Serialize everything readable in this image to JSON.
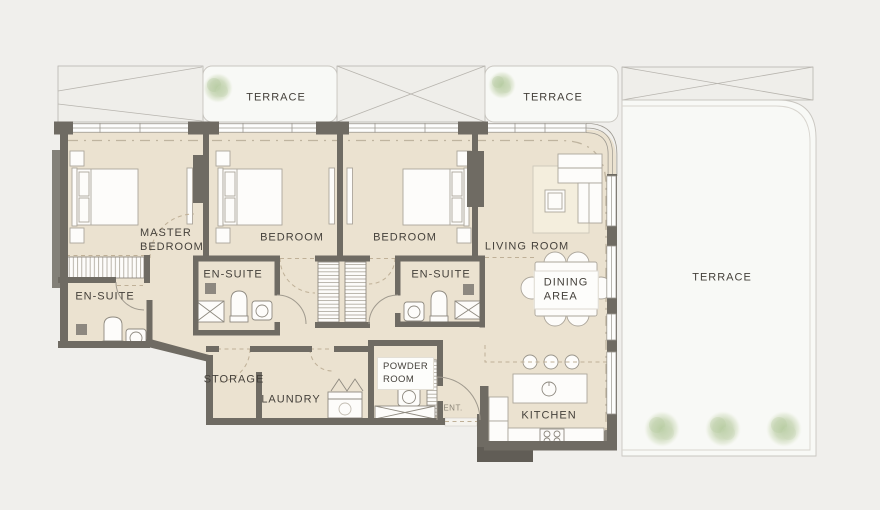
{
  "floorplan": {
    "title": "Apartment floor plan",
    "colors": {
      "background": "#f0efec",
      "floor": "#ebe2d0",
      "wall": "#6f6b63",
      "terrace": "#f8f9f6",
      "terrace_border": "#c9c6c0",
      "window": "#fdfdfc",
      "window_frame": "#9c9890",
      "tree": "#c6d5b3",
      "label_text": "#45413b",
      "dashed_line": "#bfb097"
    },
    "rooms": {
      "master_bedroom": {
        "label_line1": "MASTER",
        "label_line2": "BEDROOM"
      },
      "bedroom_2": {
        "label": "BEDROOM"
      },
      "bedroom_3": {
        "label": "BEDROOM"
      },
      "living_room": {
        "label": "LIVING ROOM"
      },
      "dining_area": {
        "label_line1": "DINING",
        "label_line2": "AREA"
      },
      "kitchen": {
        "label": "KITCHEN"
      },
      "storage": {
        "label": "STORAGE"
      },
      "laundry": {
        "label": "LAUNDRY"
      },
      "powder_room": {
        "label_line1": "POWDER",
        "label_line2": "ROOM"
      },
      "entrance": {
        "label": "ENT."
      },
      "ensuite_master": {
        "label": "EN-SUITE"
      },
      "ensuite_2": {
        "label": "EN-SUITE"
      },
      "ensuite_3": {
        "label": "EN-SUITE"
      }
    },
    "terraces": {
      "top_left": {
        "label": "TERRACE"
      },
      "top_center": {
        "label": "TERRACE"
      },
      "right": {
        "label": "TERRACE"
      }
    }
  }
}
